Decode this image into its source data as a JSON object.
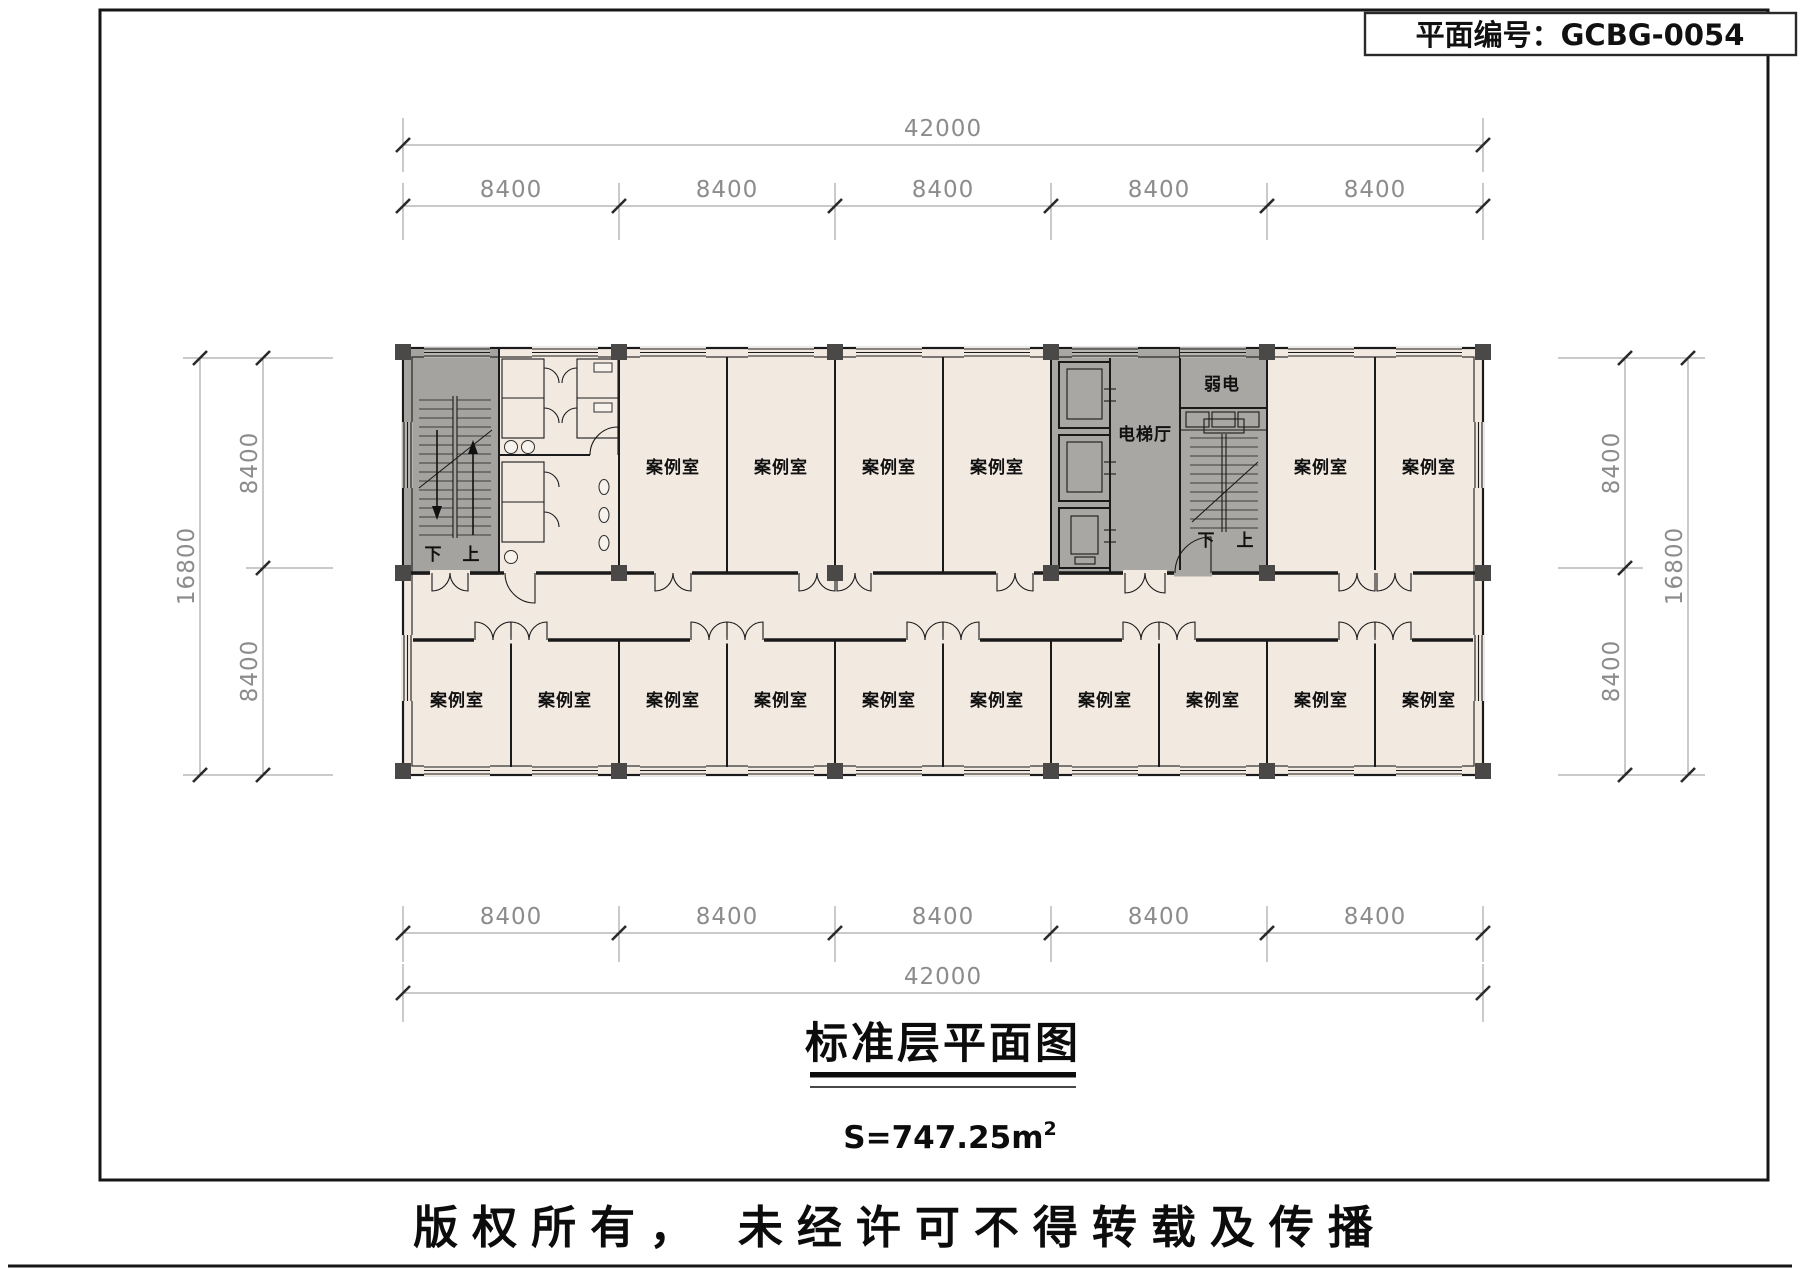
{
  "header": {
    "plan_number_label": "平面编号：GCBG-0054"
  },
  "dims": {
    "top_total": "42000",
    "top_bays": [
      "8400",
      "8400",
      "8400",
      "8400",
      "8400"
    ],
    "bottom_bays": [
      "8400",
      "8400",
      "8400",
      "8400",
      "8400"
    ],
    "bottom_total": "42000",
    "left_total": "16800",
    "left_bays": [
      "8400",
      "8400"
    ],
    "right_total": "16800",
    "right_bays": [
      "8400",
      "8400"
    ]
  },
  "plan": {
    "upper_rooms": [
      "案例室",
      "案例室",
      "案例室",
      "案例室",
      "案例室",
      "案例室"
    ],
    "lower_rooms": [
      "案例室",
      "案例室",
      "案例室",
      "案例室",
      "案例室",
      "案例室",
      "案例室",
      "案例室",
      "案例室",
      "案例室"
    ],
    "elevator_hall": "电梯厅",
    "weak_power_room": "弱电",
    "left_stair": {
      "down": "下",
      "up": "上"
    },
    "right_stair": {
      "down": "下",
      "up": "上"
    }
  },
  "title_block": {
    "title": "标准层平面图",
    "area_text": "S=747.25m",
    "area_sup": "2"
  },
  "footer": {
    "copyright": "版权所有， 未经许可不得转载及传播"
  },
  "colors": {
    "room_fill": "#f2e9e1",
    "core_fill": "#a5a3a0",
    "wall": "#1a1a1a",
    "dim_text": "#8c8c8c",
    "column": "#4b4947"
  }
}
